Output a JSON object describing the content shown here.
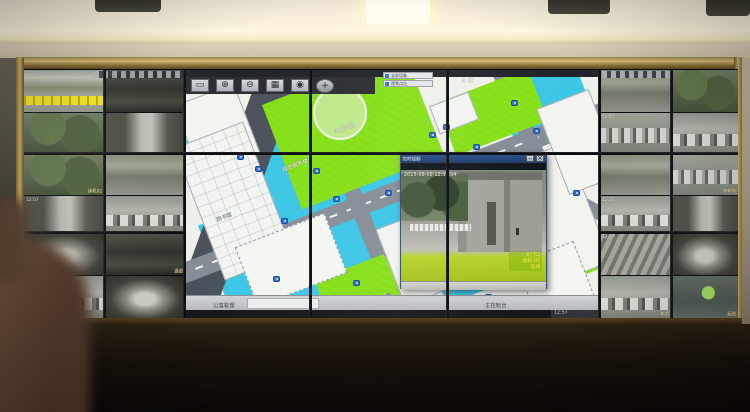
{
  "colors": {
    "map_cyan": "#3cc6e6",
    "map_green": "#84df14",
    "road_gray": "#868d97",
    "popup_titlebar": "#1d3a66",
    "alert_banner_yellow": "#f2e418",
    "frame_gold": "#c9ae6c"
  },
  "popup": {
    "title": "实时视频",
    "subtitle": "大门口球机-01 [主码流] - 视频监控",
    "timestamp": "2015-08-08 12:57:04",
    "labels": [
      "大门口",
      "球机-01",
      "在线"
    ],
    "statusbar": "云台控制",
    "min_label": "–",
    "close_label": "×"
  },
  "map": {
    "toolbar_buttons": [
      {
        "name": "select-tool-button",
        "glyph": "▭"
      },
      {
        "name": "zoom-in-tool-button",
        "glyph": "⊕"
      },
      {
        "name": "zoom-out-tool-button",
        "glyph": "⊖"
      },
      {
        "name": "layers-tool-button",
        "glyph": "▦"
      },
      {
        "name": "locate-tool-button",
        "glyph": "◉"
      }
    ],
    "pan_glyph": "+",
    "layer_boxes": [
      "全部设备",
      "视频点位"
    ],
    "labels": [
      {
        "text": "入 口",
        "x": 276,
        "y": 6,
        "rot": 0,
        "light": true
      },
      {
        "text": "中心花园",
        "x": 148,
        "y": 58,
        "rot": -21,
        "light": true
      },
      {
        "text": "综合服务楼",
        "x": 96,
        "y": 96,
        "rot": -21,
        "light": true
      },
      {
        "text": "图书馆",
        "x": 30,
        "y": 146,
        "rot": -21,
        "light": false
      },
      {
        "text": "学生宿舍区",
        "x": 214,
        "y": 212,
        "rot": 0,
        "light": true
      }
    ],
    "cameras": [
      [
        52,
        84
      ],
      [
        70,
        96
      ],
      [
        96,
        148
      ],
      [
        128,
        98
      ],
      [
        148,
        126
      ],
      [
        88,
        206
      ],
      [
        168,
        210
      ],
      [
        244,
        62
      ],
      [
        258,
        54
      ],
      [
        288,
        74
      ],
      [
        200,
        120
      ],
      [
        326,
        30
      ],
      [
        348,
        58
      ],
      [
        204,
        230
      ],
      [
        300,
        224
      ],
      [
        388,
        120
      ]
    ],
    "statusbar": {
      "left": "公寓管理",
      "right": "主控制台",
      "tray": "12:57"
    }
  },
  "left_tiles": [
    {
      "scene": "courtyard",
      "banner": true,
      "osd_top": "12:57:04"
    },
    {
      "scene": "alley",
      "osd_top": "12:57"
    },
    {
      "scene": "foliage"
    },
    {
      "scene": "lane"
    },
    {
      "scene": "foliage",
      "osd_br": "球机02"
    },
    {
      "scene": "street"
    },
    {
      "scene": "lane",
      "osd_top": "12:57"
    },
    {
      "scene": "cars"
    },
    {
      "scene": "garage"
    },
    {
      "scene": "alley",
      "osd_br": "通道"
    },
    {
      "scene": "cars",
      "osd_top": "12:57"
    },
    {
      "scene": "garage"
    }
  ],
  "right_tiles": [
    {
      "scene": "street",
      "osd_top": "12:57:04"
    },
    {
      "scene": "foliage"
    },
    {
      "scene": "parking",
      "osd_top": "12:57"
    },
    {
      "scene": "cars"
    },
    {
      "scene": "street"
    },
    {
      "scene": "parking",
      "osd_br": "停车场"
    },
    {
      "scene": "cars",
      "osd_top": "12:57"
    },
    {
      "scene": "lane"
    },
    {
      "scene": "stairs",
      "osd_top": "12:57"
    },
    {
      "scene": "garage"
    },
    {
      "scene": "cars",
      "osd_br": "车道"
    },
    {
      "scene": "window",
      "osd_br": "后院"
    }
  ]
}
